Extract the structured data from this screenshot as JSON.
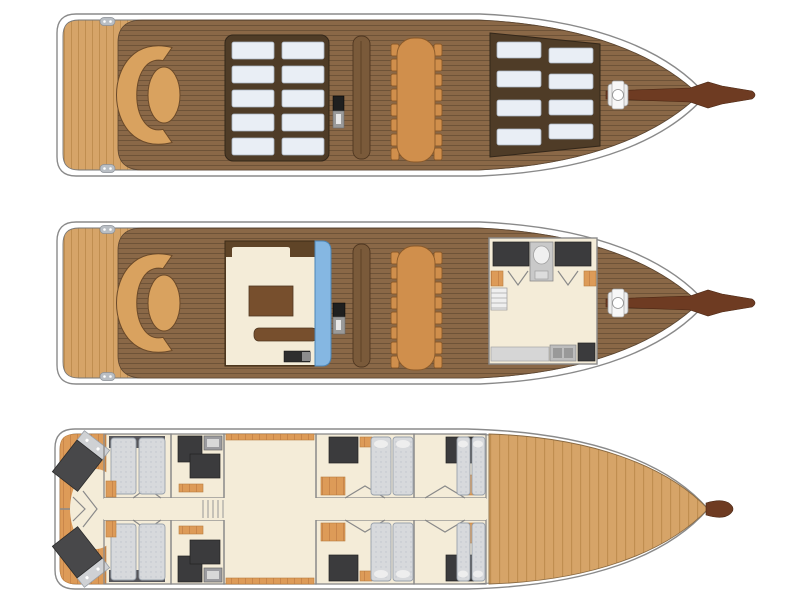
{
  "page": {
    "background": "#ffffff",
    "description": "Floor plan of a three-deck sailing yacht (gulet): sun deck, main deck and lower deck shown stacked as plan views, bow pointing right"
  },
  "colors": {
    "hull-line": "#8a8a8a",
    "deck-plank": "#8a6847",
    "plank-line": "#6e5338",
    "light-wood": "#d6a468",
    "light-wood-line": "#c08e50",
    "orange-floor": "#dd9b58",
    "orange-line": "#c9864a",
    "cream": "#f4ecd8",
    "panel-dark": "#4f3c27",
    "cushion": "#e9eef5",
    "lounge-tan": "#d9a25f",
    "table-tan": "#d08f4c",
    "bench": "#7a5a3a",
    "salon-brown": "#774f2d",
    "blue": "#85b7e2",
    "dark-fixture": "#3b3b3d",
    "mattress": "#d7d9dc",
    "spar": "#6e3b22",
    "appliance": "#9b9b9f"
  },
  "decks": [
    {
      "name": "sun deck (top plan)",
      "features": {
        "stern_swim_platform": "light teak platform with two cleats",
        "aft_lounge": "C-shaped sofa with oval table",
        "midship_sunpads": {
          "rows": 5,
          "columns": 2,
          "count": 10
        },
        "helm_console": 1,
        "deck_bench": 1,
        "dining_table": {
          "chairs_per_side": 8,
          "total_chairs": 16
        },
        "bow_sunpads": {
          "rows": 4,
          "columns": 2,
          "count": 8
        },
        "anchor_winch": 1,
        "bowsprit": 1
      }
    },
    {
      "name": "main deck (middle plan)",
      "features": {
        "stern_swim_platform": "light teak platform with two cleats",
        "aft_lounge": "C-shaped sofa with oval table",
        "salon": "deckhouse with table, sideboard, TV cabinet and blue side seat",
        "helm_console": 1,
        "deck_bench": 1,
        "dining_table": {
          "chairs_per_side": 8,
          "total_chairs": 16
        },
        "galley_wheelhouse": "forward room with counters, companionway, stairs, sink, stove and fridge",
        "anchor_winch": 1,
        "bowsprit": 1
      }
    },
    {
      "name": "lower deck (bottom plan)",
      "features": {
        "aft_cabins": {
          "count": 2,
          "bed": "angled double bed"
        },
        "twin_cabins_aft": {
          "count": 2,
          "beds_each": 2
        },
        "bathrooms": {
          "count": 2
        },
        "midship_open_room": "large open saloon / engine space",
        "forward_cabins": {
          "count": 4,
          "beds_each": 2,
          "wardrobe_each": 1
        },
        "corridor": "central fore-aft passage with companionway ladder",
        "bow_area": "planked wood sole forward storage"
      }
    }
  ]
}
